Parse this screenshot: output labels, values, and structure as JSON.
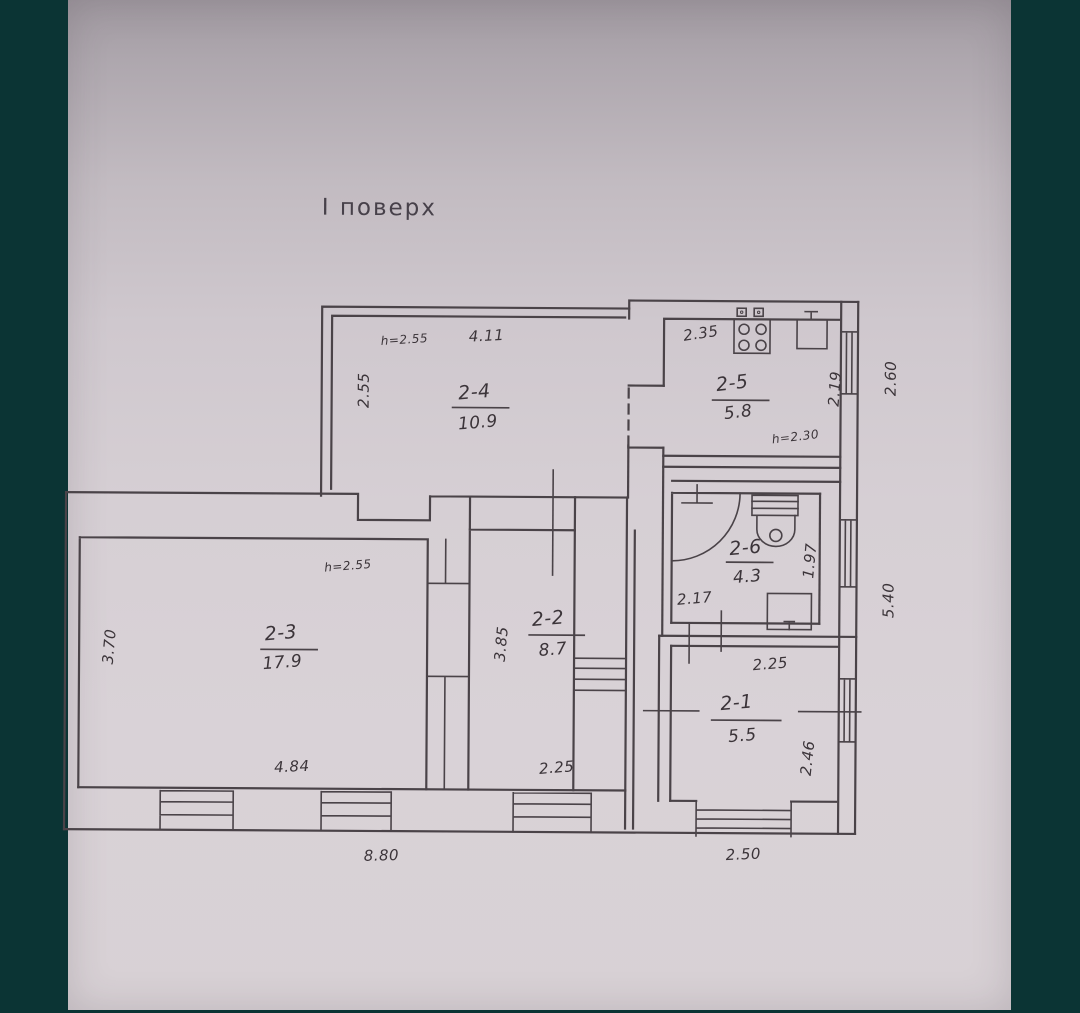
{
  "page": {
    "title": "І поверх"
  },
  "colors": {
    "backdrop": "#0b3434",
    "paper": "#d6cfd4",
    "ink": "#4a4348",
    "text": "#3b3439"
  },
  "plan": {
    "rooms": [
      {
        "id": "2-4",
        "area": "10.9",
        "width": "4.11",
        "depth": "2.55",
        "ceiling_height": "h=2.55"
      },
      {
        "id": "2-5",
        "area": "5.8",
        "width": "2.35",
        "depth": "2.19",
        "ceiling_height": "h=2.30"
      },
      {
        "id": "2-6",
        "area": "4.3",
        "width": "2.17",
        "depth": "1.97"
      },
      {
        "id": "2-2",
        "area": "8.7",
        "width": "2.25",
        "depth": "3.85"
      },
      {
        "id": "2-3",
        "area": "17.9",
        "width": "4.84",
        "depth": "3.70",
        "ceiling_height": "h=2.55"
      },
      {
        "id": "2-1",
        "area": "5.5",
        "width": "2.25",
        "depth": "2.46"
      }
    ],
    "overall_dims": {
      "bottom_left": "8.80",
      "bottom_right": "2.50",
      "right_upper": "2.60",
      "right_lower": "5.40"
    },
    "fixtures": [
      "stove-icon",
      "sink-icon",
      "toilet-icon",
      "washbasin-icon",
      "door-arc"
    ]
  }
}
